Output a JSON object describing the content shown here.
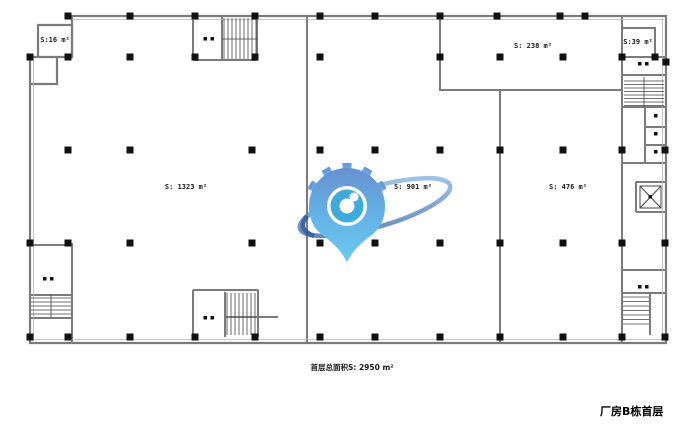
{
  "plan": {
    "title": "厂房B栋首层",
    "total_area": "首层总面积S: 2950 m²",
    "rooms": {
      "r16": {
        "label": "S:16 m²"
      },
      "r238": {
        "label": "S: 238 m²"
      },
      "r39": {
        "label": "S:39 m²"
      },
      "r1323": {
        "label": "S: 1323 m²"
      },
      "r901": {
        "label": "S: 901 m²"
      },
      "r476": {
        "label": "S: 476 m²"
      }
    }
  },
  "watermark": {
    "icon": "location-pin-gear-eye-logo",
    "colors": {
      "gear": "#5d87cf",
      "pin_top": "#5d87cf",
      "pin_bottom": "#5fc5ef",
      "orbit_ring_dark": "#2c5a9c",
      "orbit_ring_light": "#8fc1ea",
      "eye_ring": "#2fa3da"
    }
  }
}
